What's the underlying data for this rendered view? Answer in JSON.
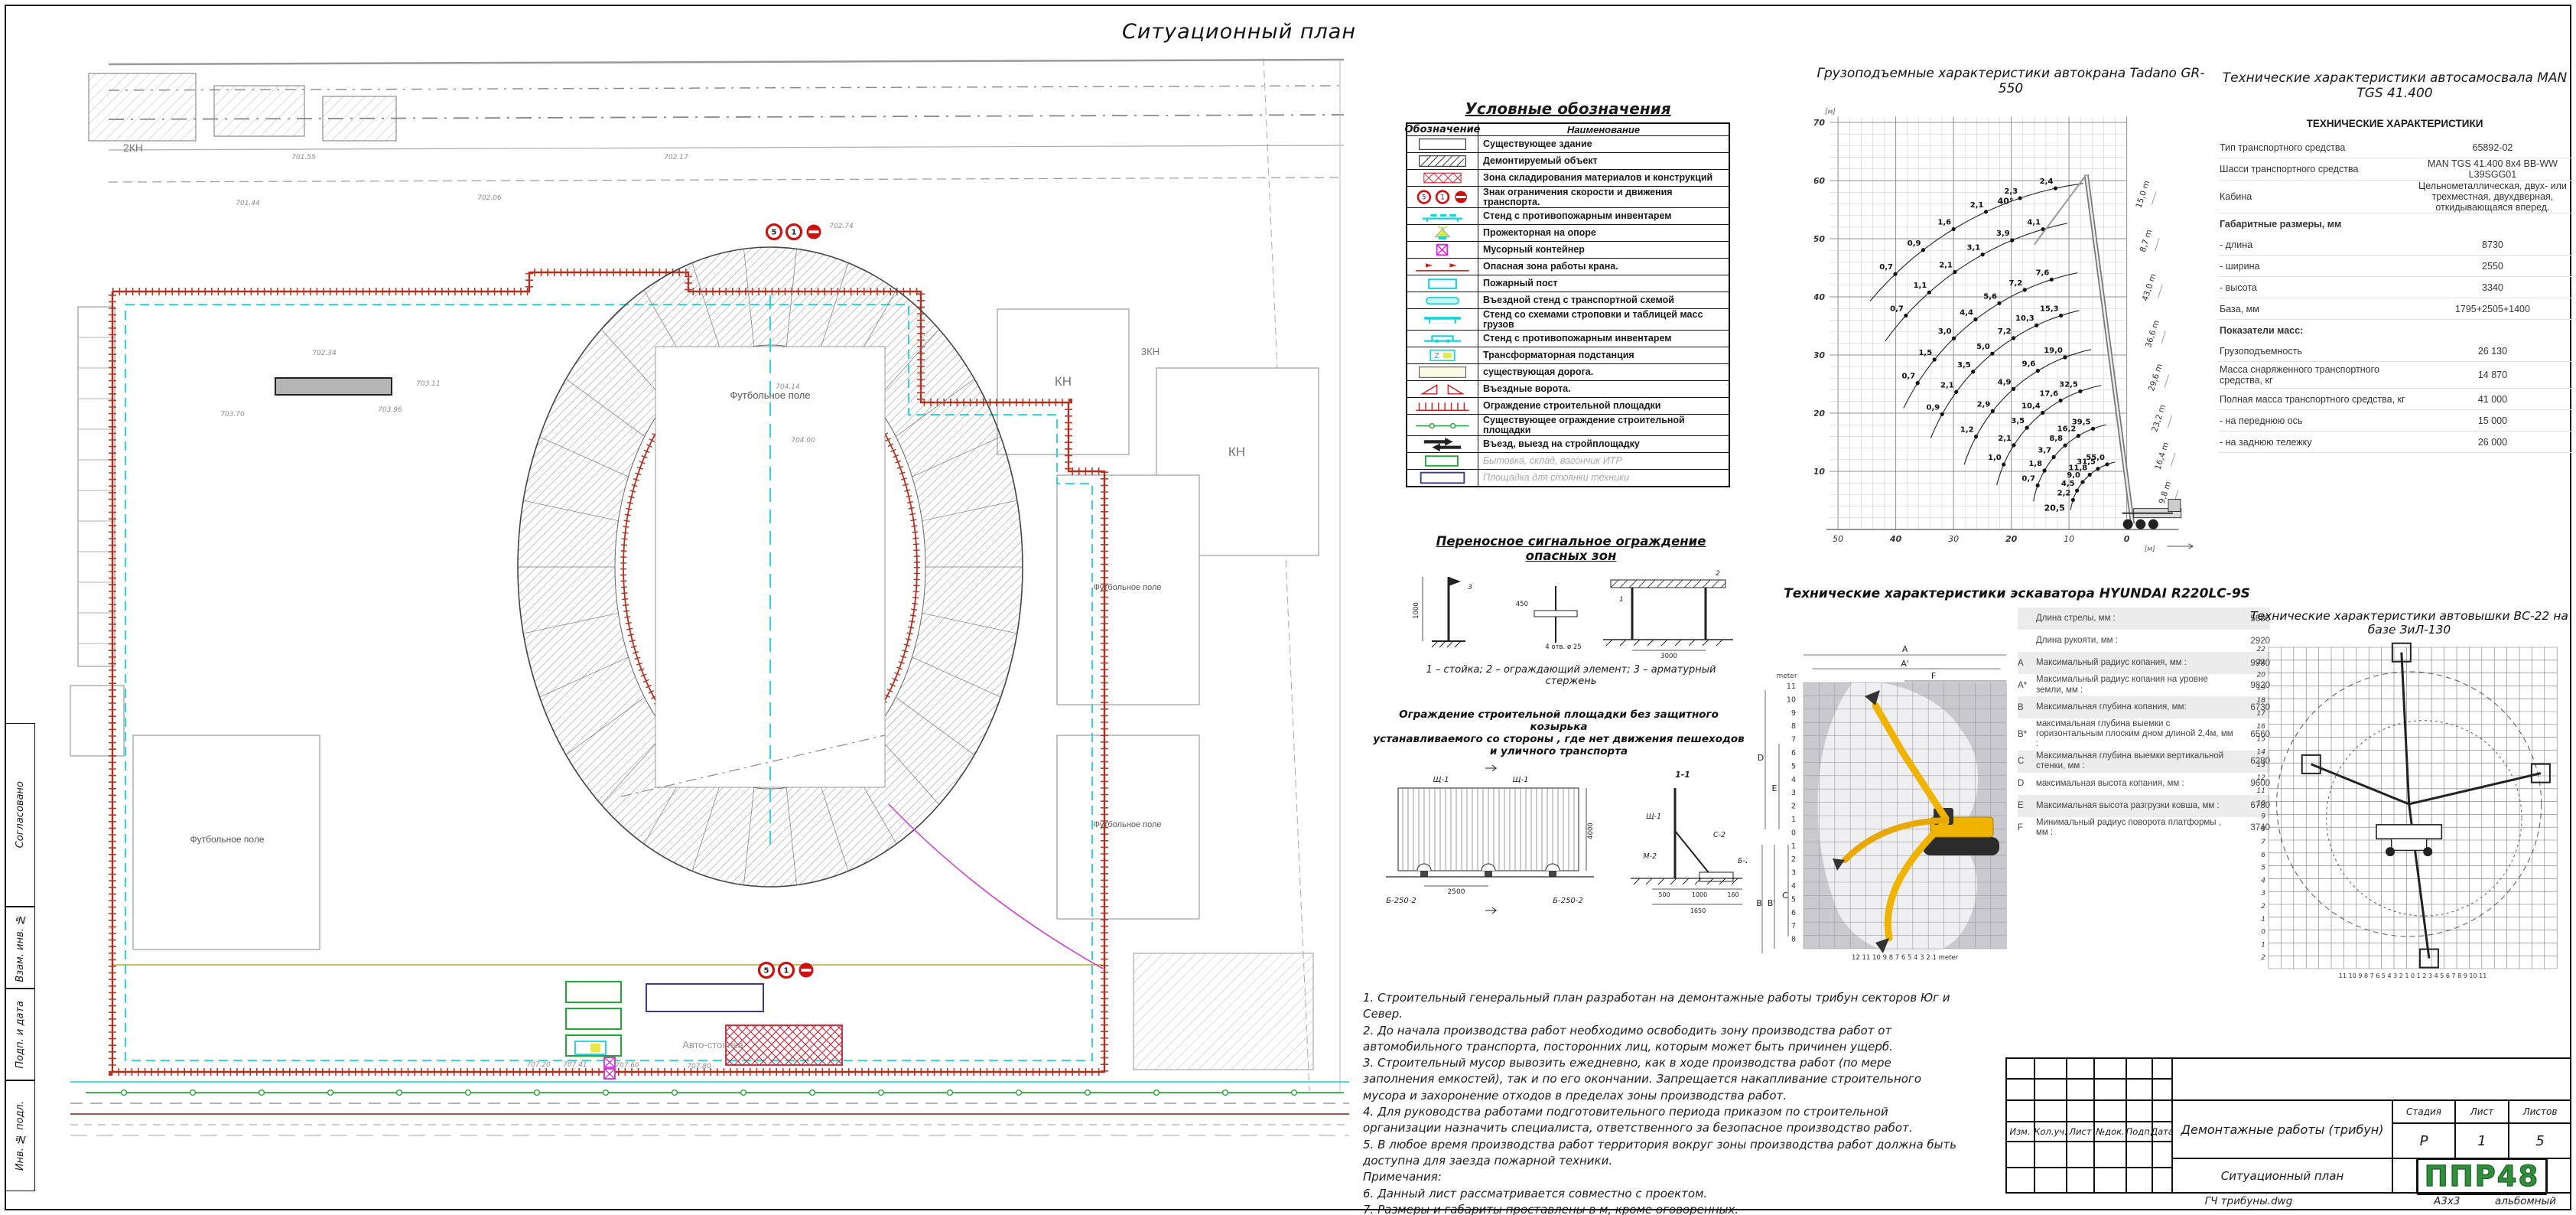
{
  "sheet": {
    "title": "Ситуационный план"
  },
  "palette": {
    "fence_red": "#b03020",
    "cyan": "#19d2d8",
    "green": "#27a63c",
    "magenta": "#d42bd4",
    "yellow": "#e8e84a",
    "logo_green": "#2f8f3a",
    "blue": "#3b3b8e",
    "road_yellow": "#e6dfa8",
    "excavator_yellow": "#f0b400",
    "hatch_gray": "#8a8a8a",
    "sign_red": "#cc1111"
  },
  "side_strip": {
    "labels": [
      "Согласовано",
      "Взам. инв. №",
      "Подп. и дата",
      "Инв. № подл."
    ]
  },
  "site_plan": {
    "labels": [
      {
        "t": "Футбольное поле",
        "x": 955,
        "y": 465,
        "s": 13,
        "c": "#555"
      },
      {
        "t": "Футбольное поле",
        "x": 245,
        "y": 1045,
        "s": 12,
        "c": "#555"
      },
      {
        "t": "Футбольное поле",
        "x": 1422,
        "y": 715,
        "s": 11,
        "c": "#555"
      },
      {
        "t": "Футбольное поле",
        "x": 1422,
        "y": 1025,
        "s": 11,
        "c": "#555"
      },
      {
        "t": "КН",
        "x": 1338,
        "y": 448,
        "s": 17,
        "c": "#777"
      },
      {
        "t": "КН",
        "x": 1565,
        "y": 540,
        "s": 17,
        "c": "#777"
      },
      {
        "t": "2КН",
        "x": 122,
        "y": 142,
        "s": 14,
        "c": "#777"
      },
      {
        "t": "3КН",
        "x": 1452,
        "y": 408,
        "s": 13,
        "c": "#777"
      },
      {
        "t": "Авто-стоянка",
        "x": 880,
        "y": 1314,
        "s": 13,
        "c": "#9a9a9a"
      }
    ],
    "elevations": [
      {
        "t": "701.44",
        "x": 272,
        "y": 212
      },
      {
        "t": "701.55",
        "x": 345,
        "y": 152
      },
      {
        "t": "702.06",
        "x": 588,
        "y": 205
      },
      {
        "t": "702.17",
        "x": 832,
        "y": 152
      },
      {
        "t": "702.74",
        "x": 1048,
        "y": 242
      },
      {
        "t": "702.34",
        "x": 372,
        "y": 408
      },
      {
        "t": "703.11",
        "x": 508,
        "y": 448
      },
      {
        "t": "703.70",
        "x": 252,
        "y": 488
      },
      {
        "t": "703.96",
        "x": 458,
        "y": 482
      },
      {
        "t": "704.14",
        "x": 978,
        "y": 452
      },
      {
        "t": "704.00",
        "x": 998,
        "y": 522
      },
      {
        "t": "707.20",
        "x": 652,
        "y": 1338
      },
      {
        "t": "707.41",
        "x": 700,
        "y": 1338
      },
      {
        "t": "707.60",
        "x": 768,
        "y": 1339
      },
      {
        "t": "707.80",
        "x": 862,
        "y": 1340
      }
    ],
    "signs": [
      "5",
      "1",
      "–"
    ]
  },
  "legend": {
    "title": "Условные обозначения",
    "col_symbol": "Обозначение",
    "col_name": "Наименование",
    "rows": [
      {
        "sym": "rect-outline",
        "name": "Существующее здание",
        "gray": false
      },
      {
        "sym": "rect-hatch",
        "name": "Демонтируемый объект",
        "gray": false
      },
      {
        "sym": "red-crosshatch",
        "name": "Зона складирования материалов и конструкций",
        "gray": false
      },
      {
        "sym": "signs",
        "name": "Знак ограничения скорости и движения транспорта.",
        "gray": false
      },
      {
        "sym": "stand-cyan",
        "name": "Стенд с противопожарным инвентарем",
        "gray": false
      },
      {
        "sym": "floodlight",
        "name": "Прожекторная на опоре",
        "gray": false
      },
      {
        "sym": "bin-magenta",
        "name": "Мусорный контейнер",
        "gray": false
      },
      {
        "sym": "crane-zone",
        "name": "Опасная зона работы крана.",
        "gray": false
      },
      {
        "sym": "fire-post",
        "name": "Пожарный пост",
        "gray": false
      },
      {
        "sym": "entry-stand",
        "name": "Въездной стенд с транспортной схемой",
        "gray": false
      },
      {
        "sym": "sling-stand",
        "name": "Стенд со схемами строповки и таблицей масс грузов",
        "gray": false
      },
      {
        "sym": "fire-stand2",
        "name": "Стенд с противопожарным инвентарем",
        "gray": false
      },
      {
        "sym": "transformer",
        "name": "Трансформаторная подстанция",
        "gray": false
      },
      {
        "sym": "road-existing",
        "name": "существующая дорога.",
        "gray": false
      },
      {
        "sym": "gates",
        "name": "Въездные ворота.",
        "gray": false
      },
      {
        "sym": "fence-new",
        "name": "Ограждение строительной площадки",
        "gray": false
      },
      {
        "sym": "fence-existing",
        "name": "Существующее ограждение строительной площадки",
        "gray": false
      },
      {
        "sym": "entry-exit",
        "name": "Въезд, выезд на стройплощадку",
        "gray": false
      },
      {
        "sym": "bytovka",
        "name": "Бытовка, склад, вагончик ИТР",
        "gray": true
      },
      {
        "sym": "tech-parking",
        "name": "Площадка для стоянки техники",
        "gray": true
      }
    ]
  },
  "signal_fence": {
    "title": "Переносное сигнальное ограждение опасных зон",
    "caption": "1 – стойка; 2 – ограждающий элемент; 3 – арматурный стержень",
    "dims": {
      "height": "1000",
      "hole": "4 отв. ø 25",
      "plate": "450",
      "span": "3000"
    },
    "callouts": [
      "1",
      "2",
      "3"
    ]
  },
  "site_fence": {
    "title_line1": "Ограждение строительной площадки без защитного козырька",
    "title_line2": "устанавливаемого со стороны , где нет движения пешеходов и уличного транспорта",
    "panel_labels": [
      "Щ-1",
      "Щ-1",
      "Б-250-2",
      "Б-250-2"
    ],
    "section_mark": "1-1",
    "section_labels": [
      "Щ-1",
      "С-2",
      "М-2",
      "Б-250-2"
    ],
    "dims": {
      "span": "2500",
      "height": "4000",
      "d1": "500",
      "d2": "1000",
      "d3": "160",
      "d4": "1650"
    }
  },
  "notes": {
    "lines": [
      "1. Строительный генеральный план разработан на  демонтажные работы трибун секторов Юг и Север.",
      "2. До начала производства работ необходимо освободить зону производства работ от автомобильного транспорта, посторонних лиц, которым может быть причинен ущерб.",
      "3. Строительный мусор вывозить ежедневно, как в ходе производства работ (по мере заполнения емкостей), так и по его окончании. Запрещается накапливание строительного мусора и захоронение отходов в пределах зоны производства работ.",
      "4. Для руководства работами подготовительного периода приказом по строительной организации назначить специалиста, ответственного за безопасное производство работ.",
      "5. В любое время производства работ территория вокруг зоны производства работ должна быть доступна для заезда пожарной техники.",
      "Примечания:",
      "6. Данный лист рассматривается совместно с проектом.",
      "7. Размеры и габариты проставлены в м, кроме оговоренных.",
      "8. Размеры и отметки со * уточнить по месту."
    ]
  },
  "crane": {
    "title": "Грузоподъемные характеристики автокрана Tadano GR-550",
    "unit": "[м]",
    "chart_data": {
      "type": "line",
      "title": "Грузоподъемные характеристики автокрана Tadano GR-550",
      "xlabel": "Вылет, м (ось развернута, 0 у крана)",
      "ylabel": "Высота подъема, м",
      "x_ticks": [
        50,
        40,
        30,
        20,
        10,
        0
      ],
      "y_ticks": [
        10,
        20,
        30,
        40,
        50,
        60,
        70
      ],
      "xlim": [
        50,
        0
      ],
      "ylim": [
        0,
        70
      ],
      "grid": true,
      "x_reversed": true,
      "boom_lengths_m": [
        9.8,
        16.4,
        23.2,
        29.6,
        36.6,
        43.0
      ],
      "jib_lengths_m": [
        8.7,
        15.0
      ],
      "series": [
        {
          "name": "стрела 43,0 м + гусёк 15,0 м",
          "L": 58.0,
          "a0": 40,
          "a1": 84,
          "capacities_t": [
            0.7,
            0.9,
            1.6,
            2.1,
            2.3,
            2.4
          ]
        },
        {
          "name": "стрела 43,0 м + гусёк 8,7 м",
          "L": 51.7,
          "a0": 36,
          "a1": 80,
          "capacities_t": [
            0.7,
            1.1,
            2.1,
            3.1,
            3.9,
            4.1
          ]
        },
        {
          "name": "стрела 43,0 м",
          "L": 43.0,
          "a0": 26,
          "a1": 79,
          "capacities_t": [
            0.7,
            1.5,
            3.0,
            4.4,
            5.6,
            7.2,
            7.6
          ]
        },
        {
          "name": "стрела 36,6 м",
          "L": 36.6,
          "a0": 22,
          "a1": 79,
          "capacities_t": [
            0.9,
            2.1,
            3.5,
            5.0,
            7.2,
            10.3,
            15.3
          ]
        },
        {
          "name": "стрела 29,6 м",
          "L": 29.6,
          "a0": 18,
          "a1": 79,
          "capacities_t": [
            1.2,
            2.9,
            4.9,
            9.6,
            19.0
          ]
        },
        {
          "name": "стрела 23,2 м",
          "L": 23.2,
          "a0": 14,
          "a1": 79,
          "capacities_t": [
            1.0,
            2.1,
            3.5,
            10.4,
            17.6,
            32.5
          ]
        },
        {
          "name": "стрела 16,4 м",
          "L": 16.4,
          "a0": 10,
          "a1": 79,
          "capacities_t": [
            0.7,
            1.8,
            3.7,
            8.8,
            16.2,
            39.5
          ]
        },
        {
          "name": "стрела 9,8 м",
          "L": 9.8,
          "a0": 8,
          "a1": 80,
          "capacities_t": [
            2.2,
            4.5,
            9.0,
            11.8,
            31.5,
            55.0
          ]
        }
      ],
      "annotations": [
        {
          "text": "40°",
          "r": 21,
          "h": 56
        },
        {
          "text": "20,5",
          "r": 12.5,
          "h": 3.2
        }
      ],
      "boom_labels": [
        "15,0 m",
        "8,7 m",
        "43,0 m",
        "36,6 m",
        "29,6 m",
        "23,2 m",
        "16,4 m",
        "9,8 m"
      ],
      "legend_position": "right-boom-brackets"
    }
  },
  "man_table": {
    "title": "Технические характеристики автосамосвала MAN TGS 41.400",
    "header": "ТЕХНИЧЕСКИЕ ХАРАКТЕРИСТИКИ",
    "rows": [
      {
        "label": "Тип транспортного средства",
        "value": "65892-02",
        "section": false
      },
      {
        "label": "Шасси транспортного средства",
        "value": "MAN TGS 41.400 8x4 BB-WW L39SGG01",
        "section": false
      },
      {
        "label": "Кабина",
        "value": "Цельнометаллическая, двух- или трехместная, двухдверная, откидывающаяся вперед.",
        "section": false
      },
      {
        "label": "Габаритные размеры, мм",
        "value": "",
        "section": true
      },
      {
        "label": "- длина",
        "value": "8730",
        "section": false
      },
      {
        "label": "- ширина",
        "value": "2550",
        "section": false
      },
      {
        "label": "- высота",
        "value": "3340",
        "section": false
      },
      {
        "label": "База, мм",
        "value": "1795+2505+1400",
        "section": false
      },
      {
        "label": "Показатели масс:",
        "value": "",
        "section": true
      },
      {
        "label": "Грузоподъемность",
        "value": "26 130",
        "section": false
      },
      {
        "label": "Масса снаряженного транспортного средства, кг",
        "value": "14 870",
        "section": false
      },
      {
        "label": "Полная масса транспортного средства, кг",
        "value": "41 000",
        "section": false
      },
      {
        "label": "- на переднюю ось",
        "value": "15 000",
        "section": false
      },
      {
        "label": "- на заднюю тележку",
        "value": "26 000",
        "section": false
      }
    ]
  },
  "excavator": {
    "title": "Технические характеристики эскаватора HYUNDAI R220LC-9S",
    "meter": "meter",
    "axis_left": [
      "11",
      "10",
      "9",
      "8",
      "7",
      "6",
      "5",
      "4",
      "3",
      "2",
      "1",
      "0",
      "1",
      "2",
      "3",
      "4",
      "5",
      "6",
      "7",
      "8"
    ],
    "axis_bottom": "12 11 10 9 8 7 6 5 4 3 2 1",
    "dim_letters": {
      "top1": "A",
      "top2": "A'",
      "top3": "F",
      "left1": "D",
      "left2": "E",
      "bot1": "B",
      "bot2": "B'",
      "bot3": "C"
    },
    "rows": [
      {
        "letter": "",
        "label": "Длина стрелы, мм :",
        "value": "5680"
      },
      {
        "letter": "",
        "label": "Длина рукояти, мм :",
        "value": "2920"
      },
      {
        "letter": "A",
        "label": "Максимальный радиус копания, мм :",
        "value": "9980"
      },
      {
        "letter": "A*",
        "label": "Максимальный радиус копания на уровне земли, мм :",
        "value": "9820"
      },
      {
        "letter": "B",
        "label": "Максимальная глубина копания, мм:",
        "value": "6730"
      },
      {
        "letter": "B*",
        "label": "максимальная глубина выемки с горизонтальным плоским дном длиной 2,4м, мм :",
        "value": "6560"
      },
      {
        "letter": "C",
        "label": "Максимальная глубина выемки вертикальной стенки, мм :",
        "value": "6280"
      },
      {
        "letter": "D",
        "label": "максимальная высота копания, мм :",
        "value": "9600"
      },
      {
        "letter": "E",
        "label": "Максимальная высота разгрузки ковша, мм :",
        "value": "6780"
      },
      {
        "letter": "F",
        "label": "Минимальный радиус поворота платформы , мм :",
        "value": "3740"
      }
    ]
  },
  "tower": {
    "title": "Технические характеристики автовышки ВС-22 на базе ЗиЛ-130",
    "axis_left": [
      "22",
      "21",
      "20",
      "19",
      "18",
      "17",
      "16",
      "15",
      "14",
      "13",
      "12",
      "11",
      "10",
      "9",
      "8",
      "7",
      "6",
      "5",
      "4",
      "3",
      "2",
      "1",
      "0",
      "1",
      "2"
    ],
    "axis_bottom": "11 10 9 8 7 6 5 4 3 2 1 0 1 2 3 4 5 6 7 8 9 10 11"
  },
  "title_block": {
    "header_cells": [
      "Изм.",
      "Кол.уч.",
      "Лист",
      "№док.",
      "Подп.",
      "Дата"
    ],
    "doc_title": "Демонтажные работы (трибун)",
    "stage_label": "Стадия",
    "sheet_label": "Лист",
    "sheets_label": "Листов",
    "stage": "Р",
    "sheet": "1",
    "sheets": "5",
    "sheet_title": "Ситуационный план",
    "logo": "ППР48",
    "file_name": "ГЧ трибуны.dwg",
    "format": "А3х3",
    "orientation": "альбомный"
  }
}
